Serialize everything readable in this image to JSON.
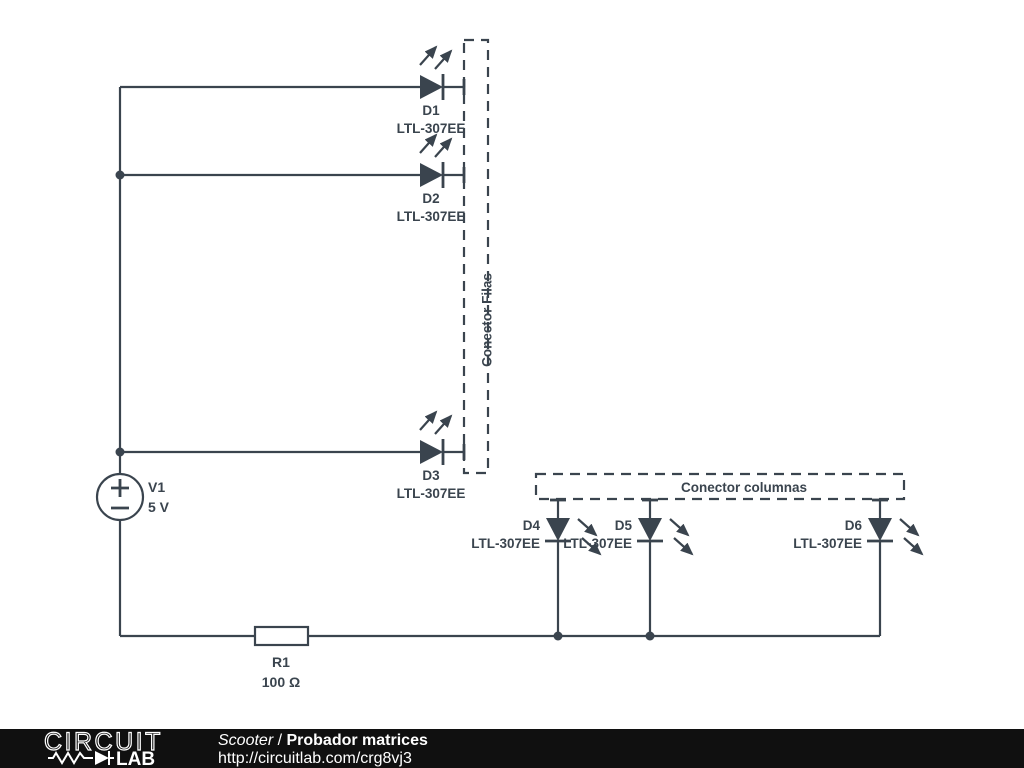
{
  "schematic": {
    "source": {
      "name": "V1",
      "value": "5 V"
    },
    "resistor": {
      "name": "R1",
      "value": "100 Ω"
    },
    "diodes": [
      {
        "name": "D1",
        "part": "LTL-307EE"
      },
      {
        "name": "D2",
        "part": "LTL-307EE"
      },
      {
        "name": "D3",
        "part": "LTL-307EE"
      },
      {
        "name": "D4",
        "part": "LTL-307EE"
      },
      {
        "name": "D5",
        "part": "LTL-307EE"
      },
      {
        "name": "D6",
        "part": "LTL-307EE"
      }
    ],
    "connectors": {
      "rows": "Conector Filas",
      "columns": "Conector columnas"
    }
  },
  "footer": {
    "logo": {
      "word1": "CIRCUIT",
      "word2": "LAB"
    },
    "author": "Scooter",
    "separator": " / ",
    "title": "Probador matrices",
    "url": "http://circuitlab.com/crg8vj3"
  },
  "colors": {
    "ink": "#3a444e",
    "footer_bg": "#101010",
    "footer_text": "#ffffff"
  }
}
